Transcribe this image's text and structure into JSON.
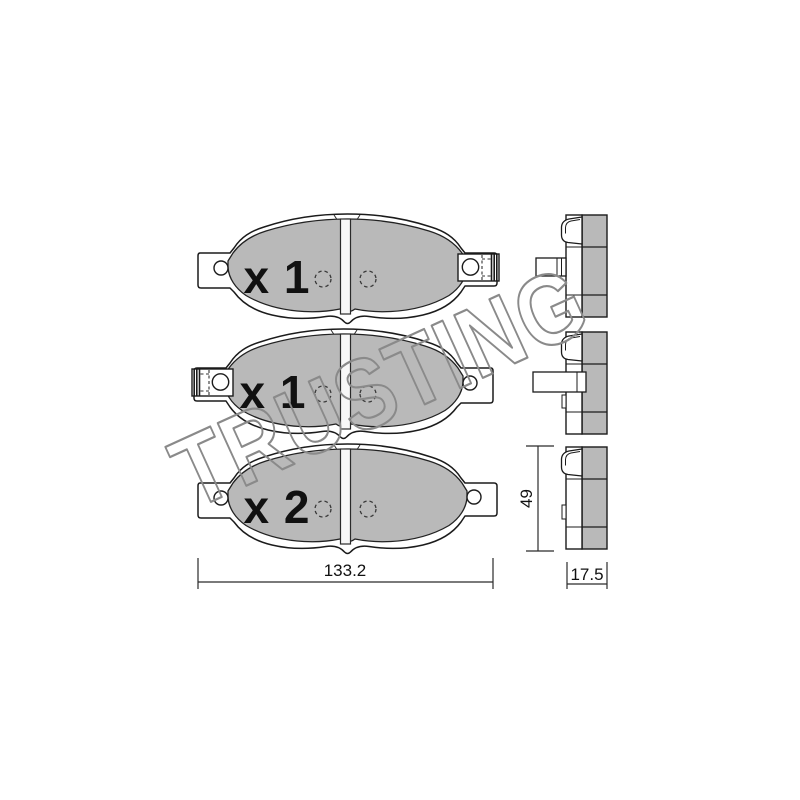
{
  "drawing": {
    "title": "brake-pad-set-technical-drawing",
    "watermark": "TRUSTING",
    "pads": [
      {
        "id": 1,
        "quantity_label": "x 1",
        "clip_side": "right"
      },
      {
        "id": 2,
        "quantity_label": "x 1",
        "clip_side": "left"
      },
      {
        "id": 3,
        "quantity_label": "x 2",
        "clip_side": "none"
      }
    ],
    "dimensions": {
      "width": "133.2",
      "height": "49",
      "thickness": "17.5"
    },
    "colors": {
      "friction": "#b9b9b9",
      "outline": "#1b1b1b",
      "watermark": "#8a8a8a",
      "slot": "#f7f7f7",
      "background": "#ffffff"
    }
  }
}
